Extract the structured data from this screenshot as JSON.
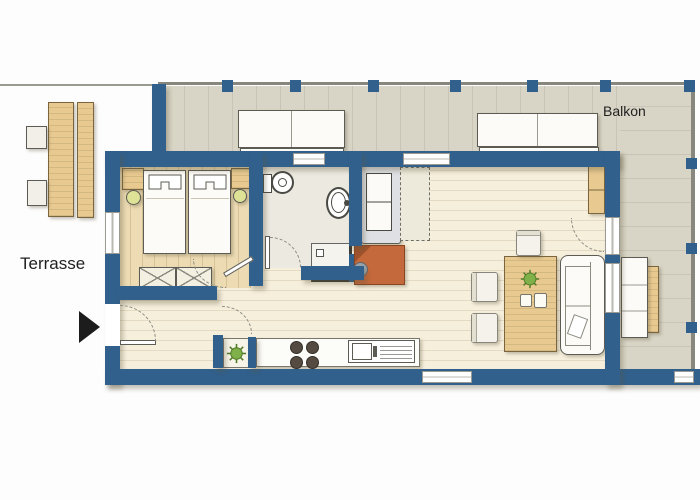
{
  "labels": {
    "terrace": "Terrasse",
    "balcony": "Balkon"
  },
  "colors": {
    "wall": "#31608c",
    "outline": "#5c5c55",
    "living_floor": "#f6efdc",
    "bedroom_floor": "#ecdbb3",
    "bath_floor": "#ebe9e0",
    "balcony_floor": "#d9d5c6",
    "furniture_wood": "#e8ca90",
    "orange_unit": "#c4693c",
    "plant_green": "#7fb04a",
    "lamp_green": "#dde296",
    "burner_dark": "#564b41",
    "cushion_white": "#fcfbf7",
    "railing_gray": "#87877d",
    "arrow_black": "#1c1c1c"
  },
  "furniture": [
    "terrace-table",
    "terrace-chairs",
    "balcony-benches",
    "double-beds",
    "nightstands-with-lamps",
    "storage-bench",
    "toilet",
    "washbasin",
    "shower",
    "sofa-bed-with-foldout",
    "tiled-stove",
    "kitchen-counter-hob-sink",
    "dining-table-with-plant",
    "dining-chairs",
    "sofa",
    "sideboard",
    "plants"
  ]
}
